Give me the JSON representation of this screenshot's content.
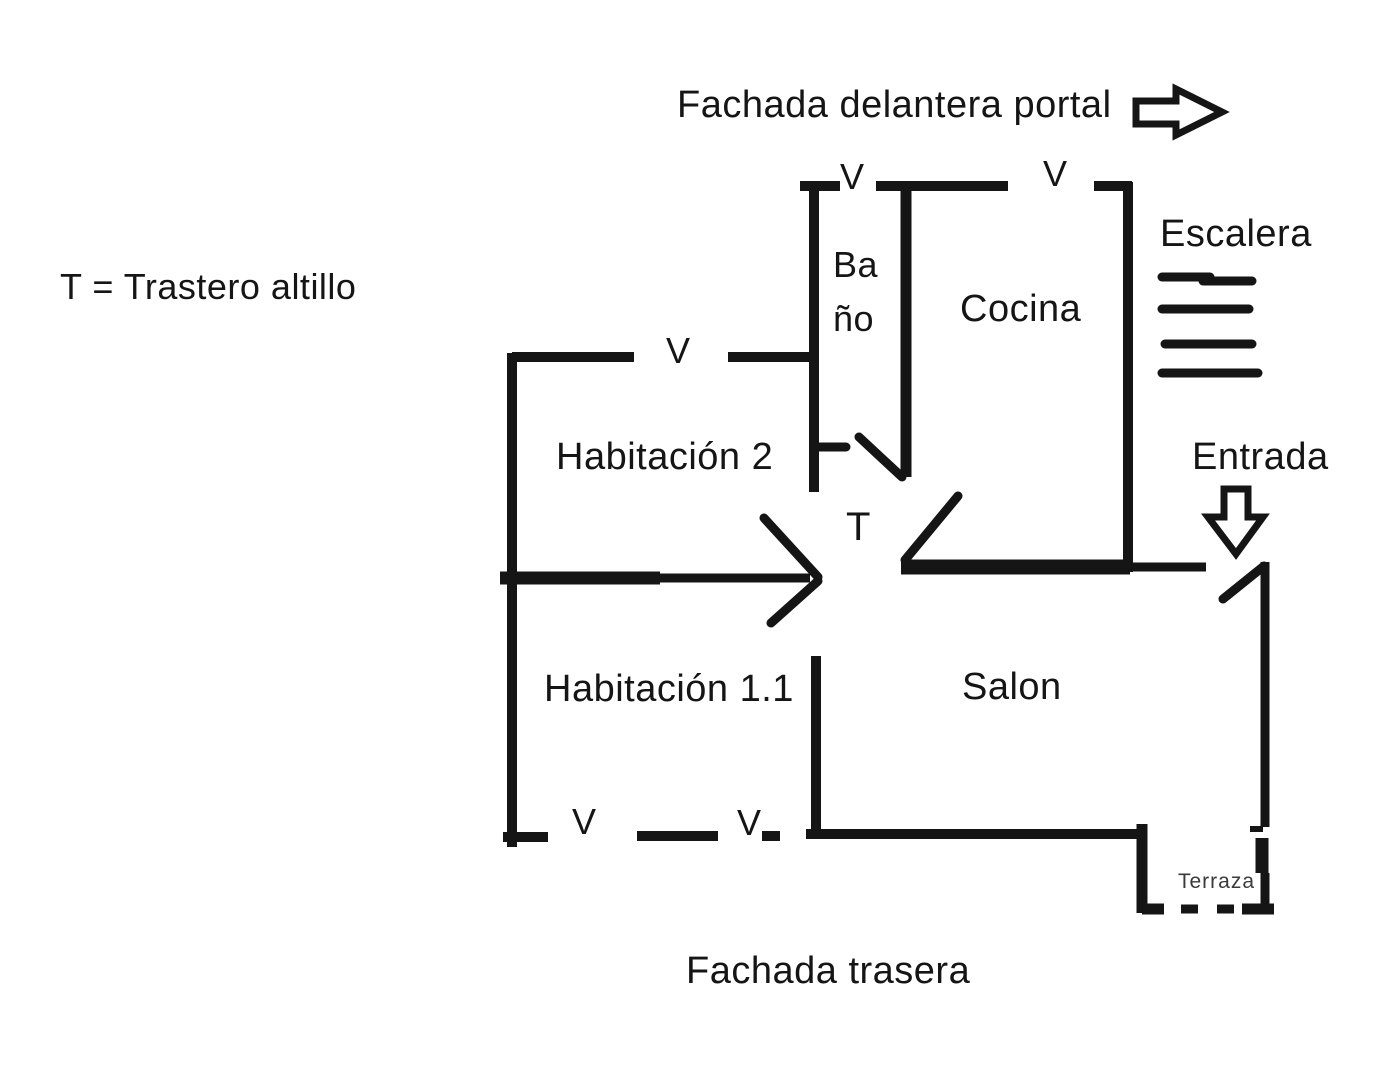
{
  "colors": {
    "ink": "#151515",
    "terraza_text": "#3a3a3a",
    "background": "#ffffff"
  },
  "header": {
    "front_facade_label": "Fachada delantera portal"
  },
  "legend": {
    "text": "T = Trastero altillo"
  },
  "rooms": {
    "bano": {
      "label_line1": "Ba",
      "label_line2": "ño"
    },
    "cocina": {
      "label": "Cocina"
    },
    "habitacion2": {
      "label": "Habitación 2"
    },
    "habitacion11": {
      "label": "Habitación 1.1"
    },
    "salon": {
      "label": "Salon"
    },
    "terraza": {
      "label": "Terraza"
    },
    "trastero_marker": {
      "label": "T"
    }
  },
  "stairs": {
    "label": "Escalera",
    "step_count": 4
  },
  "entrance": {
    "label": "Entrada"
  },
  "footer": {
    "rear_facade_label": "Fachada trasera"
  },
  "windows": [
    {
      "id": "bano-top-window",
      "label": "V"
    },
    {
      "id": "cocina-top-window",
      "label": "V"
    },
    {
      "id": "habitacion2-top-window",
      "label": "V"
    },
    {
      "id": "habitacion11-bottom-left-window",
      "label": "V"
    },
    {
      "id": "habitacion11-bottom-right-window",
      "label": "V"
    }
  ]
}
